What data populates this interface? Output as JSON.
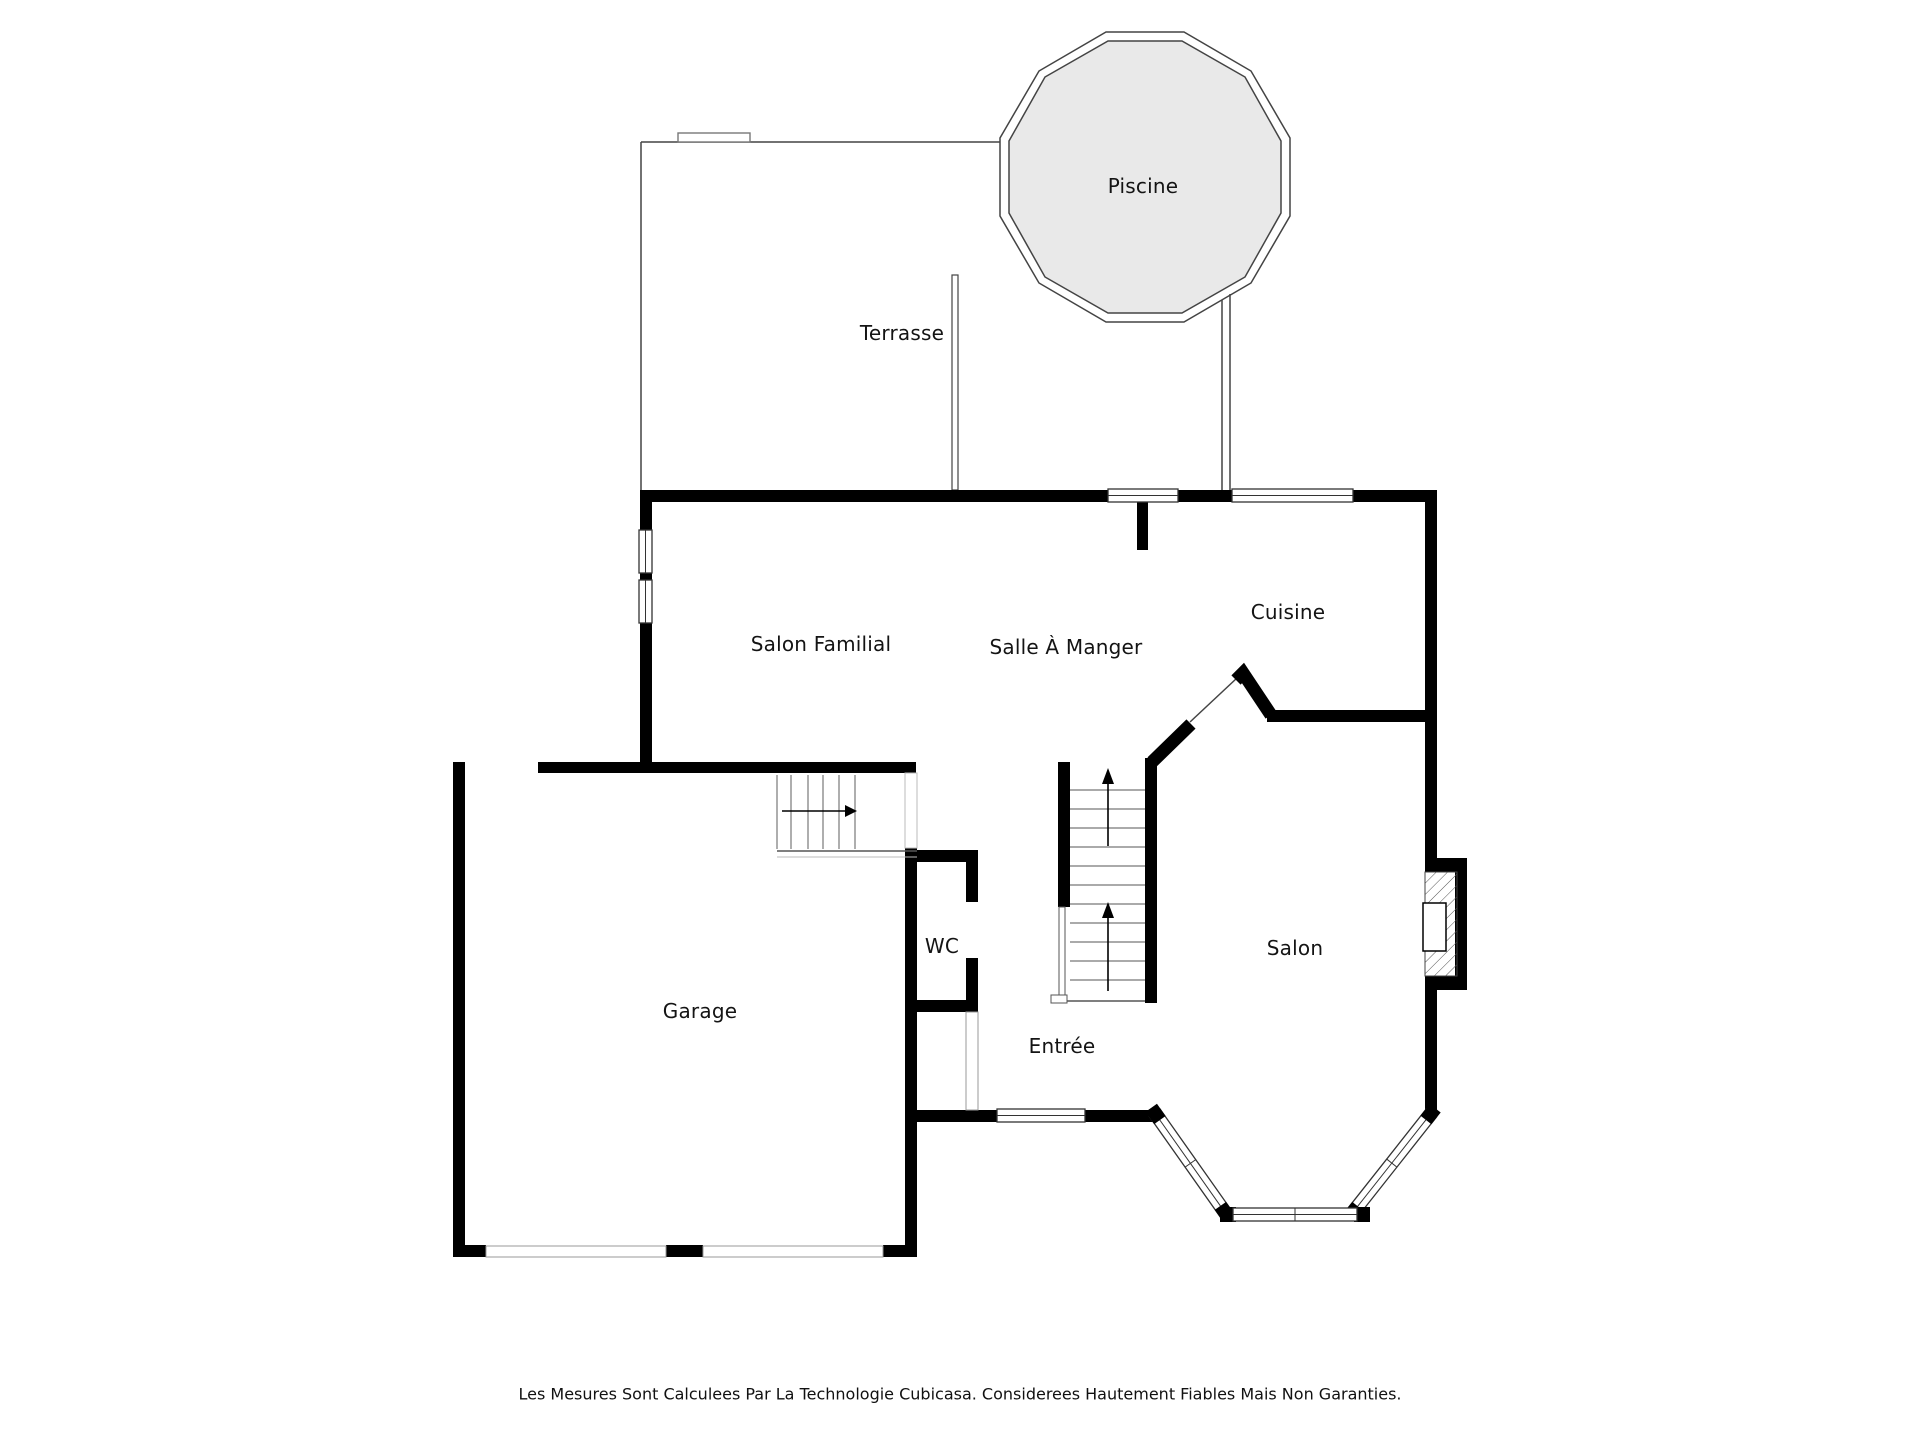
{
  "rooms": {
    "piscine": {
      "label": "Piscine"
    },
    "terrasse": {
      "label": "Terrasse"
    },
    "salon_familial": {
      "label": "Salon Familial"
    },
    "salle_a_manger": {
      "label": "Salle À Manger"
    },
    "cuisine": {
      "label": "Cuisine"
    },
    "salon": {
      "label": "Salon"
    },
    "entree": {
      "label": "Entrée"
    },
    "wc": {
      "label": "WC"
    },
    "garage": {
      "label": "Garage"
    }
  },
  "disclaimer": "Les Mesures Sont Calculees Par La Technologie Cubicasa. Considerees Hautement Fiables Mais Non Garanties.",
  "icons": {
    "stair_up_arrow": "up-arrow",
    "stair_right_arrow": "right-arrow"
  },
  "colors": {
    "wall": "#000000",
    "thin_line": "#444444",
    "pool_fill": "#e9e9e9",
    "text": "#141414",
    "muted_line": "#888888",
    "background": "#ffffff"
  }
}
